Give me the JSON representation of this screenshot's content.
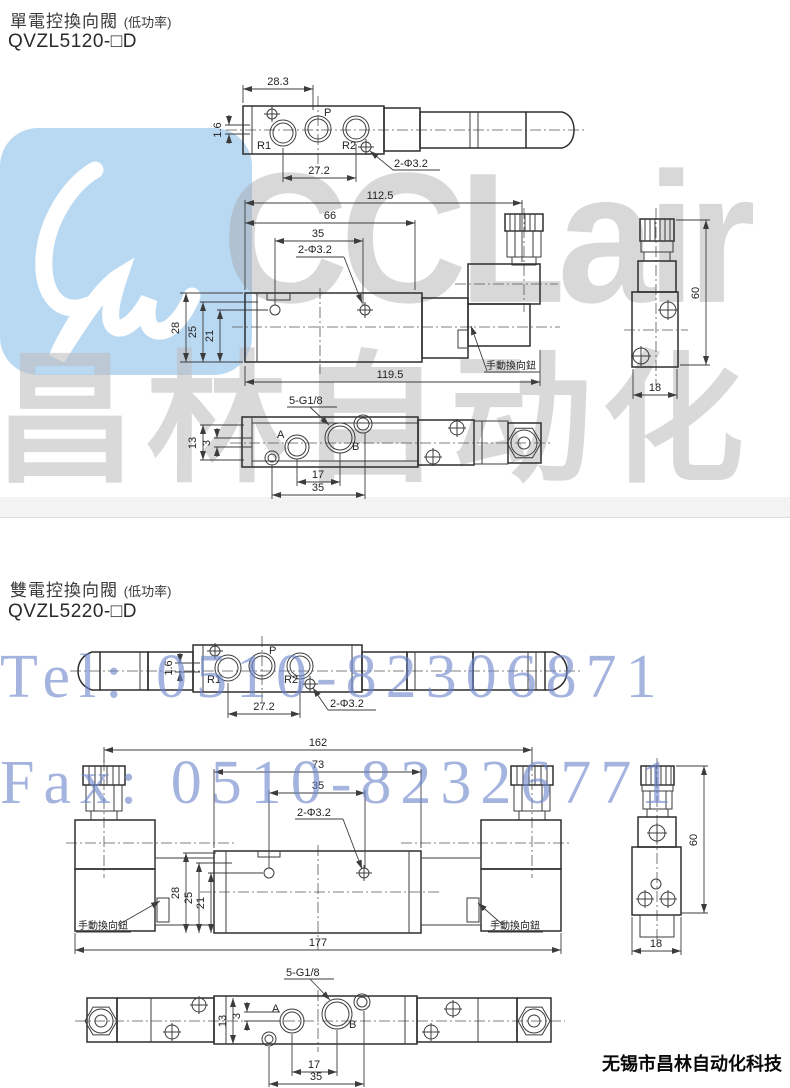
{
  "watermarks": {
    "logo_text": "CCLair",
    "brand_cn": "昌林自动化",
    "tel": "Tel: 0510-82306871",
    "fax": "Fax: 0510-82326771",
    "logo_blue": "#b9d9f3",
    "gray": "#a4a4a4",
    "blue_text": "#6d87cd"
  },
  "footer": {
    "company": "无锡市昌林自动化科技"
  },
  "s1": {
    "title": "單電控換向閥",
    "title_note": "(低功率)",
    "model": "QVZL5120-□D",
    "top": {
      "w": "28.3",
      "offset": "1.6",
      "r1": "R1",
      "p": "P",
      "r2": "R2",
      "pitch": "27.2",
      "holes": "2-Φ3.2"
    },
    "front": {
      "l1": "112.5",
      "l2": "66",
      "l3": "35",
      "holes": "2-Φ3.2",
      "h1": "28",
      "h2": "25",
      "h3": "21",
      "l4": "119.5",
      "manual": "手動換向鈕"
    },
    "side": {
      "h": "60",
      "w": "18"
    },
    "bottom": {
      "thread": "5-G1/8",
      "h1": "13",
      "h2": "3",
      "a": "A",
      "b": "B",
      "p1": "17",
      "p2": "35"
    }
  },
  "s2": {
    "title": "雙電控換向閥",
    "title_note": "(低功率)",
    "model": "QVZL5220-□D",
    "top": {
      "offset": "1.6",
      "r1": "R1",
      "p": "P",
      "r2": "R2",
      "pitch": "27.2",
      "holes": "2-Φ3.2"
    },
    "front": {
      "l1": "162",
      "l2": "73",
      "l3": "35",
      "holes": "2-Φ3.2",
      "h1": "28",
      "h2": "25",
      "h3": "21",
      "l4": "177",
      "manual_left": "手動換向鈕",
      "manual_right": "手動換向鈕"
    },
    "side": {
      "h": "60",
      "w": "18"
    },
    "bottom": {
      "thread": "5-G1/8",
      "h1": "13",
      "h2": "3",
      "a": "A",
      "b": "B",
      "p1": "17",
      "p2": "35"
    }
  }
}
